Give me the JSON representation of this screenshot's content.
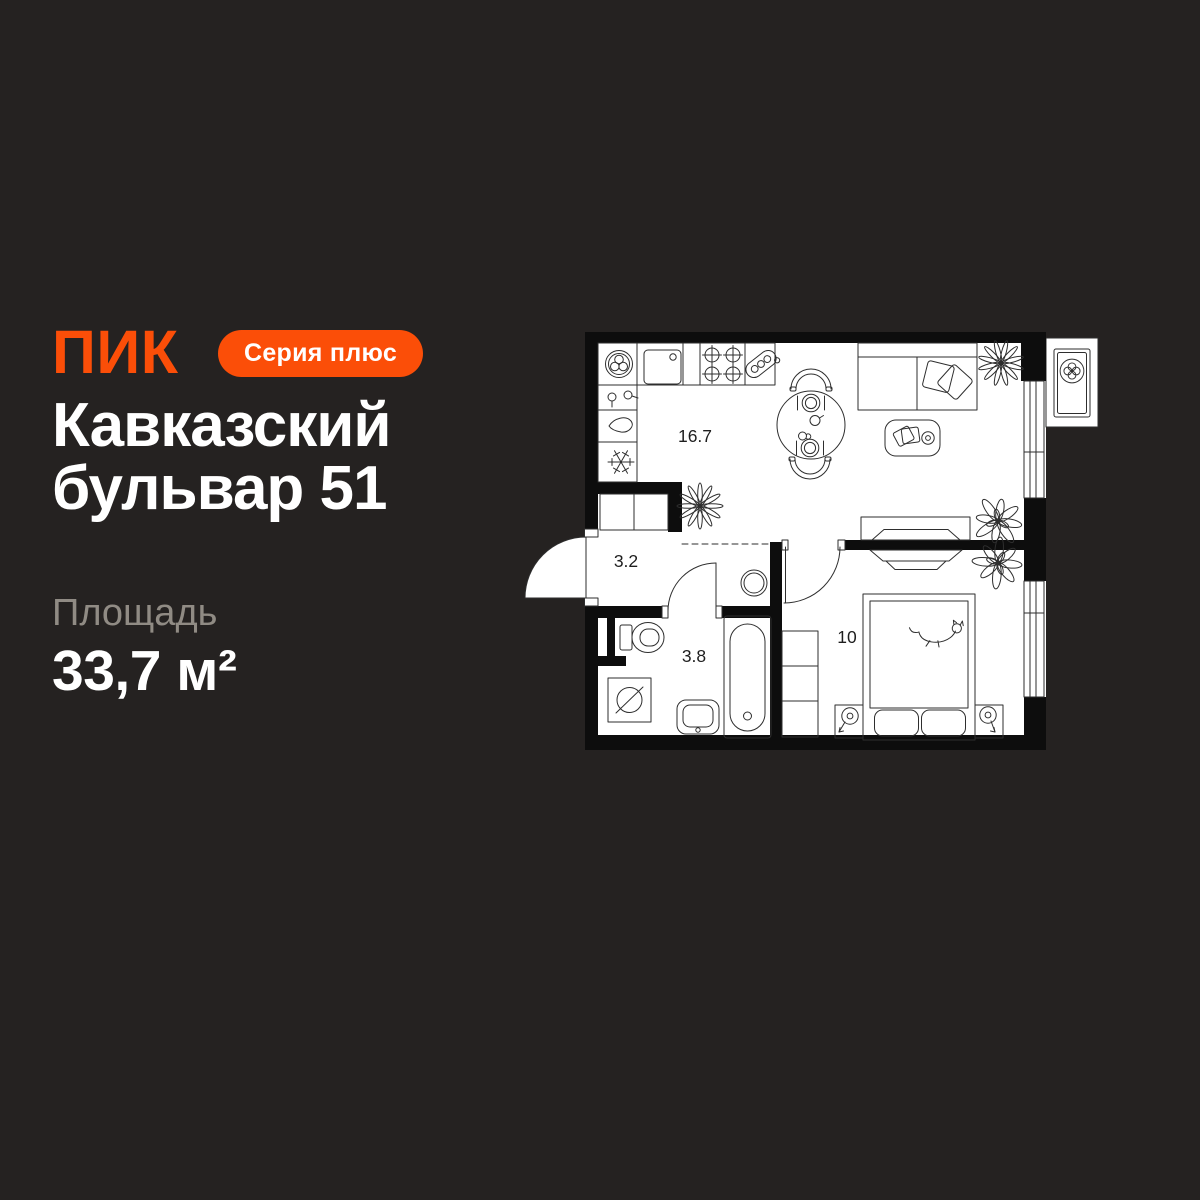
{
  "page": {
    "background_color": "#252221"
  },
  "brand": {
    "logo_text": "ПИК",
    "badge_label": "Серия плюс",
    "accent_color": "#FB4E08"
  },
  "listing": {
    "title_line1": "Кавказский",
    "title_line2": "бульвар 51",
    "area_label": "Площадь",
    "area_value": "33,7 м²"
  },
  "floor_plan": {
    "rooms": [
      {
        "name": "kitchen-living-room",
        "area": "16.7"
      },
      {
        "name": "hallway",
        "area": "3.2"
      },
      {
        "name": "bathroom",
        "area": "3.8"
      },
      {
        "name": "bedroom",
        "area": "10"
      }
    ],
    "colors": {
      "floor": "#FFFFFF",
      "walls": "#0D0D0D",
      "lines": "#2E2E2E",
      "labels": "#1E1E1E"
    },
    "fixture_icons": [
      "fridge-snowflake-icon",
      "water-drop-icon",
      "faucet-handles-icon",
      "disposal-plate-icon",
      "kitchen-sink-icon",
      "stove-burners-icon",
      "kitchen-scale-icon",
      "dining-table-icon",
      "chair-icon",
      "place-setting-icon",
      "teapot-icon",
      "cup-icon",
      "sofa-icon",
      "sofa-pillows-icon",
      "coffee-table-icon",
      "books-icon",
      "tv-console-icon",
      "dresser-icon",
      "plant-star-icon",
      "plant-leaf-icon",
      "hall-wardrobe-icon",
      "bedroom-wardrobe-icon",
      "entrance-door-icon",
      "bathroom-door-icon",
      "bedroom-door-icon",
      "window-icon",
      "balcony-ac-fan-icon",
      "water-heater-icon",
      "toilet-icon",
      "bathtub-icon",
      "washbasin-icon",
      "washing-machine-icon",
      "double-bed-icon",
      "bed-pillow-icon",
      "cat-icon",
      "nightstand-lamp-icon"
    ]
  }
}
